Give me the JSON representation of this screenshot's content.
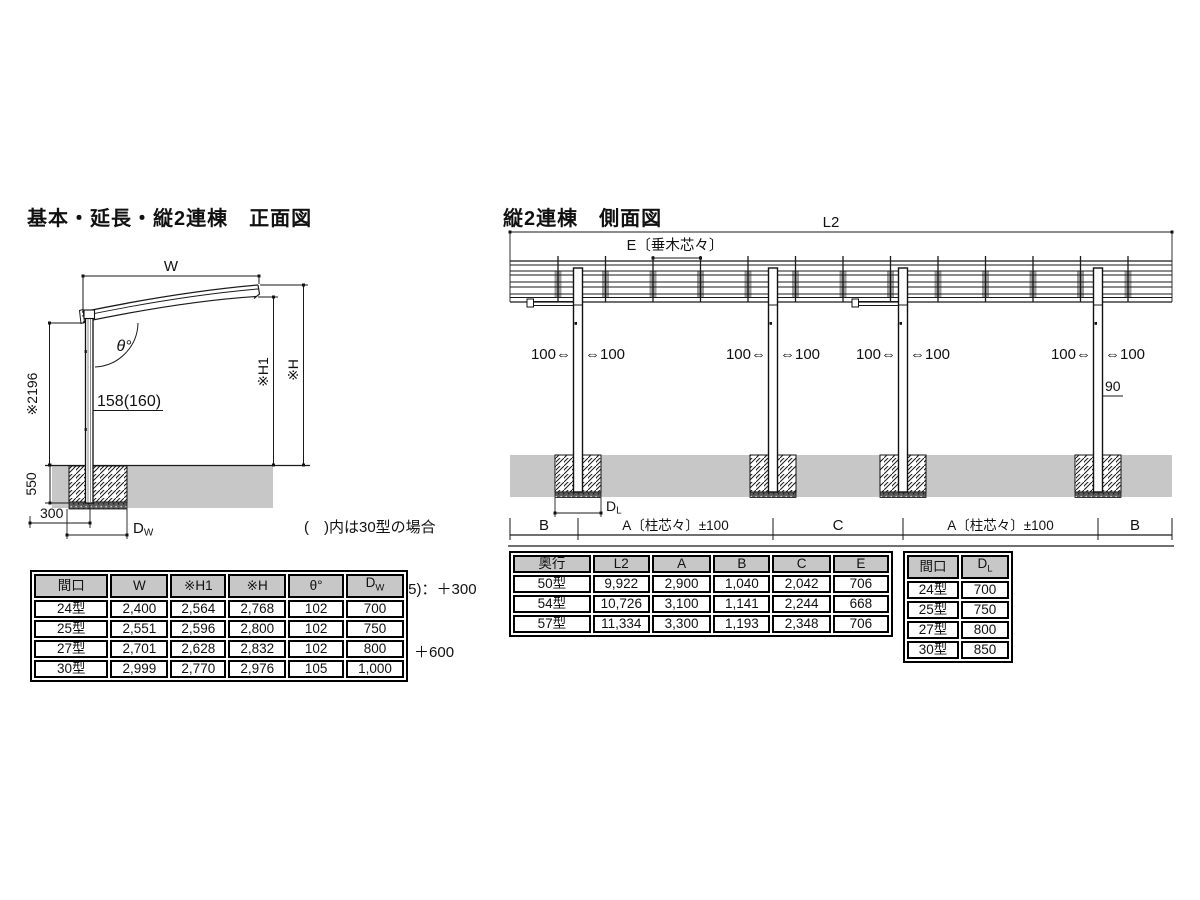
{
  "front_view": {
    "title": "基本・延長・縦2連棟　正面図",
    "labels": {
      "w": "W",
      "theta": "θ°",
      "post_section": "158(160)",
      "post_height": "※2196",
      "h1": "※H1",
      "h": "※H",
      "foundation_depth": "550",
      "footing_offset": "300",
      "dw_main": "D",
      "dw_sub": "W"
    },
    "notes": {
      "line1": "(　)内は30型の場合",
      "line2": "※)ロング柱(H25)：＋300",
      "line3": "　H28柱(H28)：＋600"
    }
  },
  "side_view": {
    "title": "縦2連棟　側面図",
    "labels": {
      "l2": "L2",
      "rafter_pitch": "E〔垂木芯々〕",
      "offset_left": "100⇔",
      "offset_right": "⇔100",
      "eave_edge": "90",
      "span_b": "B",
      "span_a": "A〔柱芯々〕±100",
      "span_c": "C",
      "dl_main": "D",
      "dl_sub": "L"
    }
  },
  "tables": {
    "width": {
      "headers": [
        "間口",
        "W",
        "※H1",
        "※H",
        "θ°"
      ],
      "dw": {
        "main": "D",
        "sub": "W"
      },
      "rows": [
        [
          "24型",
          "2,400",
          "2,564",
          "2,768",
          "102",
          "700"
        ],
        [
          "25型",
          "2,551",
          "2,596",
          "2,800",
          "102",
          "750"
        ],
        [
          "27型",
          "2,701",
          "2,628",
          "2,832",
          "102",
          "800"
        ],
        [
          "30型",
          "2,999",
          "2,770",
          "2,976",
          "105",
          "1,000"
        ]
      ]
    },
    "depth": {
      "headers": [
        "奥行",
        "L2",
        "A",
        "B",
        "C",
        "E"
      ],
      "rows": [
        [
          "50型",
          "9,922",
          "2,900",
          "1,040",
          "2,042",
          "706"
        ],
        [
          "54型",
          "10,726",
          "3,100",
          "1,141",
          "2,244",
          "668"
        ],
        [
          "57型",
          "11,334",
          "3,300",
          "1,193",
          "2,348",
          "706"
        ]
      ]
    },
    "frontage": {
      "maguchi_header": "間口",
      "dl": {
        "main": "D",
        "sub": "L"
      },
      "rows": [
        [
          "24型",
          "700"
        ],
        [
          "25型",
          "750"
        ],
        [
          "27型",
          "800"
        ],
        [
          "30型",
          "850"
        ]
      ]
    }
  },
  "colors": {
    "ground_gray": "#c7c7c7",
    "header_gray": "#c7c7c7",
    "line_black": "#1a1a1a"
  }
}
